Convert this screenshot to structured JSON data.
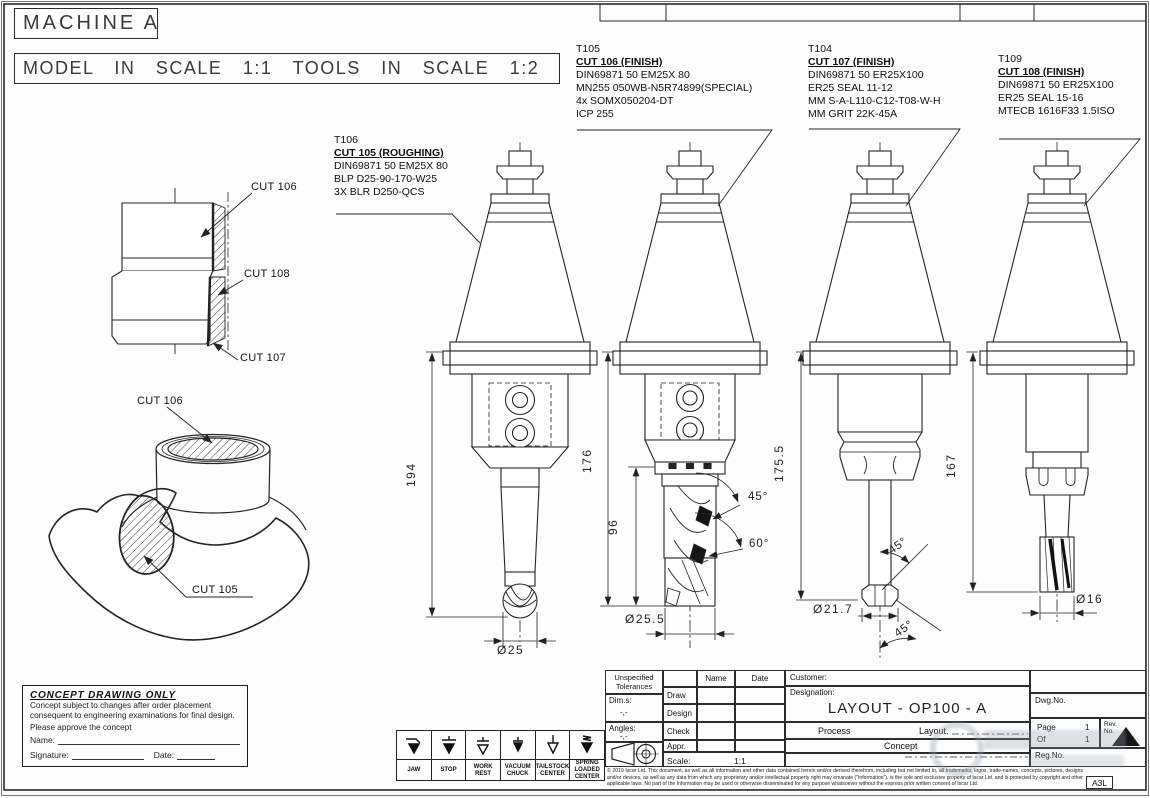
{
  "header": {
    "machine": "MACHINE A",
    "scale_note": "MODEL IN SCALE 1:1 TOOLS IN SCALE 1:2"
  },
  "tool_notes": [
    {
      "id": "T106",
      "cut": "CUT 105 (ROUGHING)",
      "specs": [
        "DIN69871 50 EM25X 80",
        "BLP D25-90-170-W25",
        "3X BLR D250-QCS"
      ]
    },
    {
      "id": "T105",
      "cut": "CUT 106 (FINISH)",
      "specs": [
        "DIN69871 50 EM25X 80",
        "MN255 050WB-N5R74899(SPECIAL)",
        "4x SOMX050204-DT",
        "ICP 255"
      ]
    },
    {
      "id": "T104",
      "cut": "CUT 107 (FINISH)",
      "specs": [
        "DIN69871 50 ER25X100",
        "ER25 SEAL 11-12",
        "MM S-A-L110-C12-T08-W-H",
        "MM GRIT 22K-45A"
      ]
    },
    {
      "id": "T109",
      "cut": "CUT 108 (FINISH)",
      "specs": [
        "DIN69871 50 ER25X100",
        "ER25 SEAL 15-16",
        "MTECB 1616F33 1.5ISO"
      ]
    }
  ],
  "part_labels": {
    "section_top": "CUT 106",
    "section_mid": "CUT 108",
    "section_bot": "CUT 107",
    "iso_top": "CUT 106",
    "iso_pocket": "CUT 105"
  },
  "dimensions": {
    "t1_length": "194",
    "t1_dia": "Ø25",
    "t2_length": "176",
    "t2_flute": "96",
    "t2_dia": "Ø25.5",
    "t2_angle1": "45°",
    "t2_angle2": "60°",
    "t3_length": "175.5",
    "t3_dia": "Ø21.7",
    "t3_angle1": "45°",
    "t3_angle2": "45°",
    "t4_length": "167",
    "t4_dia": "Ø16"
  },
  "concept_box": {
    "title": "CONCEPT DRAWING ONLY",
    "body1": "Concept subject to changes after order placement",
    "body2": "consequent to engineering examinations for final design.",
    "body3": "Please approve the concept",
    "name_label": "Name:",
    "signature_label": "Signature:",
    "date_label": "Date:"
  },
  "fixture_symbols": [
    {
      "name": "jaw",
      "label": "JAW"
    },
    {
      "name": "stop",
      "label": "STOP"
    },
    {
      "name": "work-rest",
      "label": "WORK REST"
    },
    {
      "name": "vacuum-chuck",
      "label": "VACUUM CHUCK"
    },
    {
      "name": "tailstock-center",
      "label": "TAILSTOCK CENTER"
    },
    {
      "name": "spring-loaded-center",
      "label": "SPRING LOADED CENTER"
    }
  ],
  "title_block": {
    "tolerances": "Unspecified Tolerances",
    "dims_label": "Dim.s:",
    "dims_value": "-,-",
    "angles_label": "Angles:",
    "angles_value": "-,-",
    "name_header": "Name",
    "date_header": "Date",
    "row_draw": "Draw",
    "row_design": "Design",
    "row_check": "Check",
    "row_appr": "Appr.",
    "scale_label": "Scale:",
    "scale_value": "1:1",
    "customer_label": "Customer:",
    "designation_label": "Designation:",
    "designation_value": "LAYOUT - OP100 - A",
    "process_label": "Process",
    "layout_label": "Layout.",
    "concept_label": "Concept",
    "dwg_no_label": "Dwg.No.",
    "page_label": "Page",
    "page_value": "1",
    "of_label": "Of",
    "of_value": "1",
    "rev_label": "Rev.",
    "rev_no_label": "No.",
    "reg_no_label": "Reg.No.",
    "format": "A3L",
    "legal": "© 2019 Iscar Ltd. This document, as well as all information and other data contained herein and/or derived therefrom, including but not limited to, all trademarks, logos, trade-names, concepts, pictures, designs and/or devices, as well as any data from which any proprietary and/or intellectual property right may emanate (\"Information\"), is the sole and exclusive property of Iscar Ltd. and is protected by copyright and other applicable laws. No part of the Information may be used or otherwise disseminated for any purpose whatsoever without the express prior written consent of Iscar Ltd."
  }
}
